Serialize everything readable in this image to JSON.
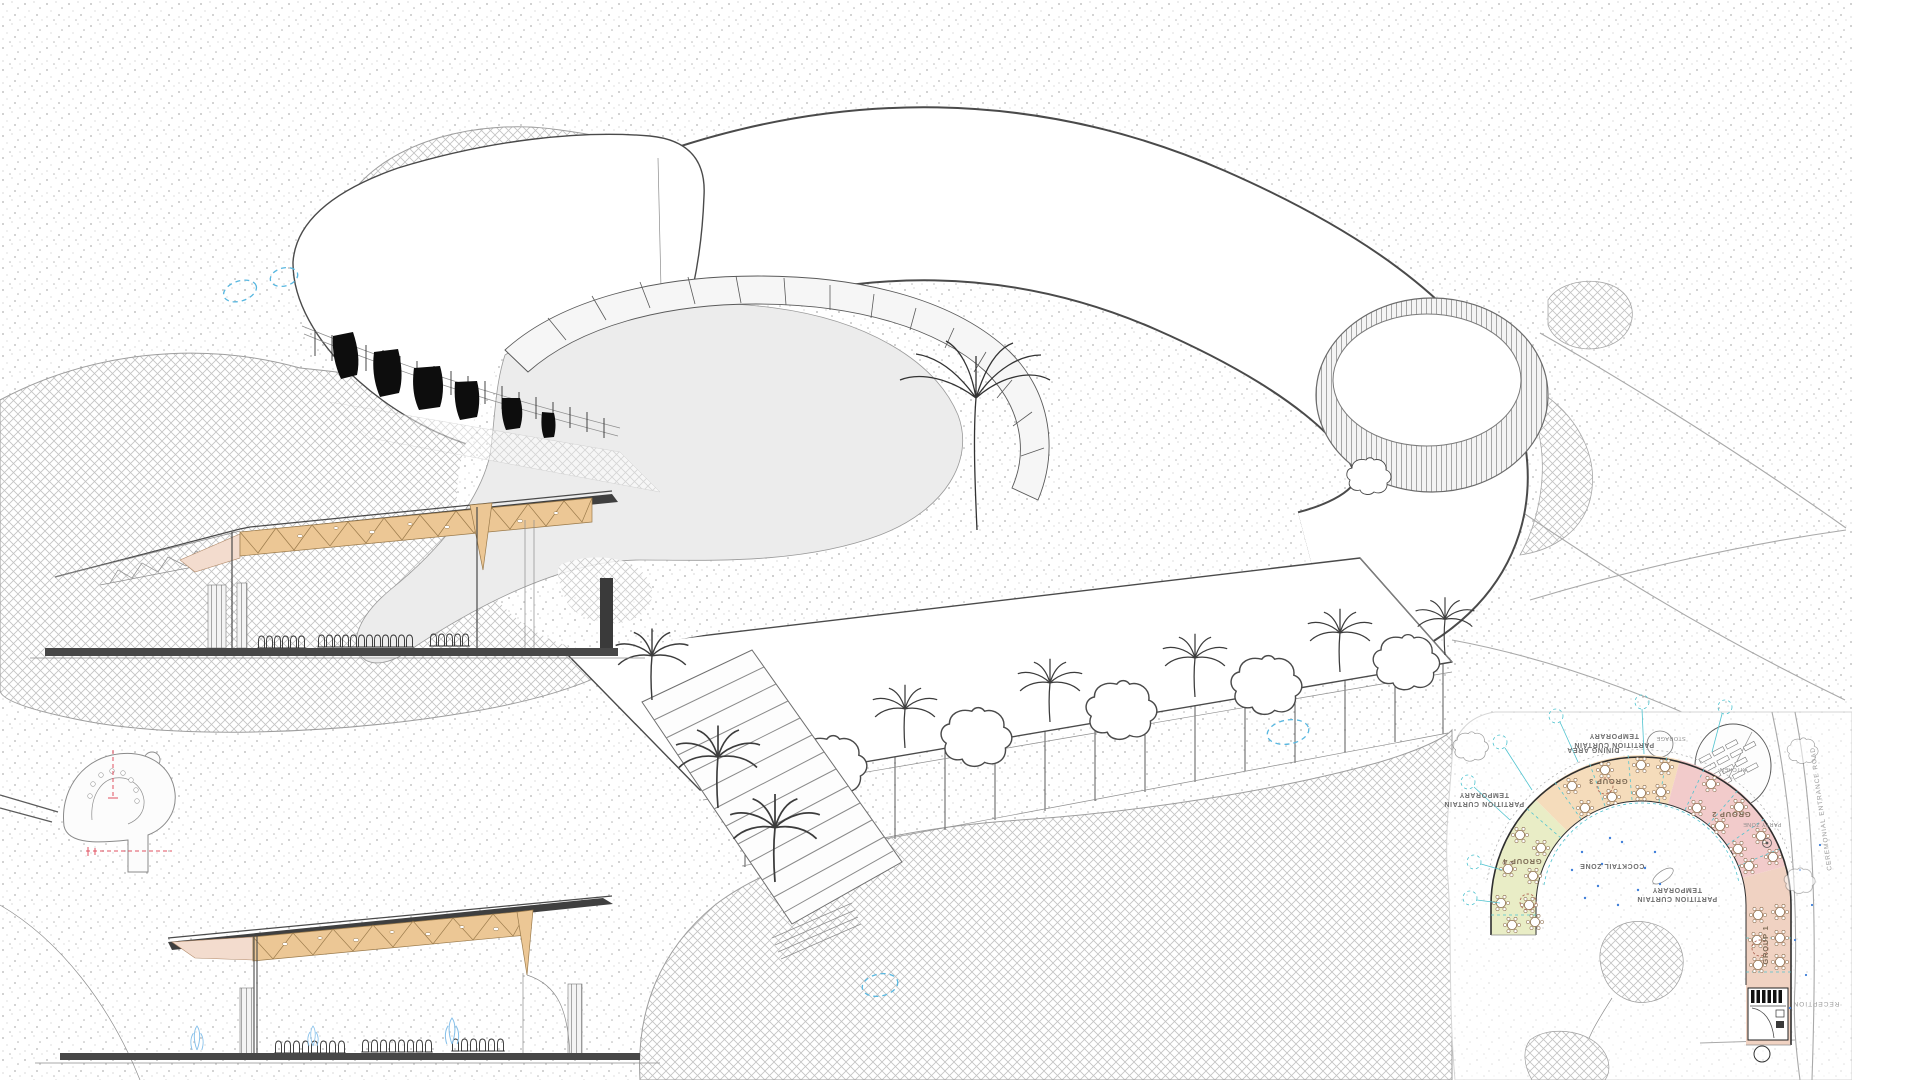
{
  "plan": {
    "partition_curtain": {
      "line1": "TEMPORARY",
      "line2": "PARTITION CURTAIN"
    },
    "labels": {
      "dining_area": "DINING AREA",
      "cocktail_zone": "COCKTAIL ZONE",
      "reception": "RECEPTION",
      "entrance_road": "CEREMONIAL ENTRANCE ROAD",
      "kitchen": "KITCHEN",
      "storage": "STORAGE",
      "party_zone": "PARTY ZONE"
    },
    "groups": [
      {
        "label": "GROUP 1"
      },
      {
        "label": "GROUP 2"
      },
      {
        "label": "GROUP 3"
      },
      {
        "label": "GROUP 4"
      }
    ],
    "zone_colors": {
      "group1": "#f0d2c2",
      "group2": "#f2cbcb",
      "group3": "#f5dcbb",
      "group4": "#e9edc6"
    }
  },
  "colors": {
    "annotation_blue": "#58b7e0",
    "partition_cyan": "#4fc3cf",
    "cut_line_red": "#e05060",
    "soffit_tan": "#ecc795",
    "soffit_pink": "#f3dcce",
    "ink": "#4a4a4a"
  }
}
